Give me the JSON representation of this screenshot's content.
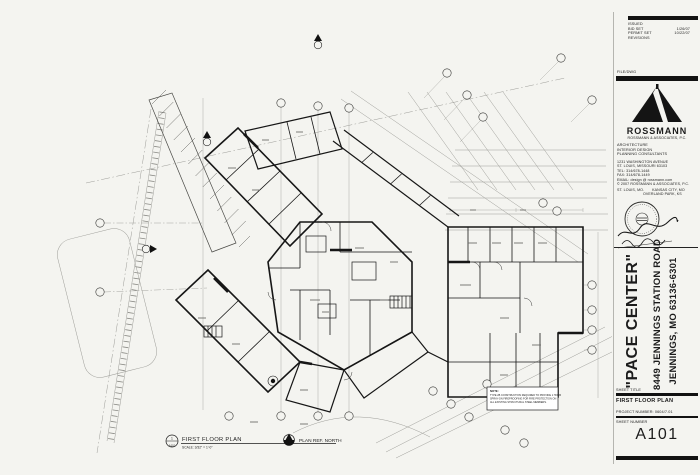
{
  "title_block": {
    "issued_label": "ISSUED",
    "issued_rows": [
      {
        "name": "BID SET",
        "date": "1/26/07"
      },
      {
        "name": "PERMIT SET",
        "date": "10/22/07"
      }
    ],
    "revisions_label": "REVISIONS",
    "file_label": "FILE/DWG",
    "firm": {
      "name": "ROSSMANN",
      "legal": "ROSSMANN & ASSOCIATES, P.C.",
      "services": [
        "ARCHITECTURE",
        "INTERIOR DESIGN",
        "PLANNING CONSULTANTS"
      ],
      "address": [
        "1231 WASHINGTON AVENUE",
        "ST. LOUIS, MISSOURI 63103",
        "TEL:  314/678-1448",
        "FAX:  314/678-1449",
        "EMAIL:  design @ rossmann.com",
        "© 2007 ROSSMANN & ASSOCIATES, P.C."
      ],
      "offices": [
        "ST. LOUIS, MO.",
        "KANSAS CITY, MO",
        "OVERLAND PARK, KS"
      ]
    },
    "project": {
      "name": "\"PACE CENTER\"",
      "address1": "8449 JENNINGS STATION ROAD",
      "address2": "JENNINGS, MO  63136-6301"
    },
    "sheet_title_label": "SHEET TITLE",
    "sheet_title": "FIRST FLOOR PLAN",
    "project_number_label": "PROJECT NUMBER:",
    "project_number": "0604/7.01",
    "sheet_number_label": "SHEET NUMBER",
    "sheet_number": "A101"
  },
  "drawing": {
    "ref_number": "1",
    "ref_sheet": "A101",
    "title": "FIRST FLOOR PLAN",
    "scale": "SCALE: 3/32\" = 1'-0\"",
    "north_label": "PLAN REF. NORTH",
    "note_lines": [
      "NOTE:",
      "TYPE 2B CONSTRUCTION REQUIRED TO PROVIDE 1 HOUR",
      "SPRAY-ON FIREPROOFING FOR FIRE PROTECTION ON",
      "ALL EXISTING STRUCTURAL STEEL MEMBERS."
    ]
  }
}
